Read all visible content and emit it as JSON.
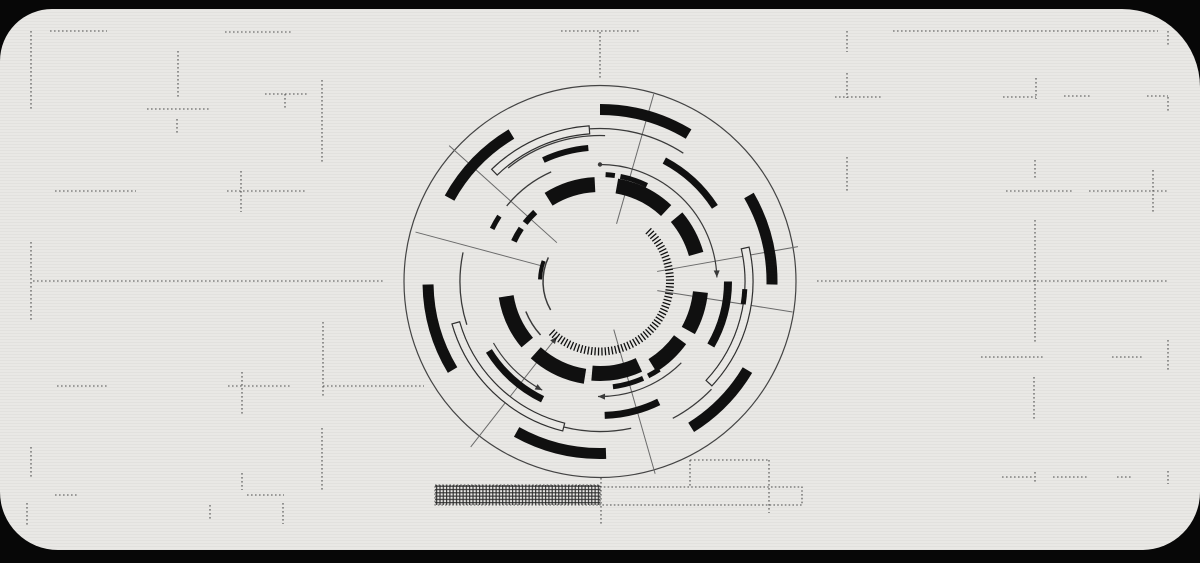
{
  "canvas": {
    "w": 1200,
    "h": 563,
    "bg": "#070707"
  },
  "panel": {
    "fill": "#e9e8e5"
  },
  "colors": {
    "solid_arc": "#101010",
    "thin_arc": "#3a3a3a",
    "outer_circle": "#444444",
    "spoke": "#6b6b6b",
    "dash_line": "#4f4f4f",
    "band_stroke": "#2f2f2f",
    "band_fill": "#e9e8e5",
    "hatch": "#2a2a2a"
  },
  "background_lines": [
    {
      "dir": "h",
      "x": 50,
      "y": 31,
      "len": 57
    },
    {
      "dir": "h",
      "x": 225,
      "y": 32,
      "len": 66
    },
    {
      "dir": "h",
      "x": 147,
      "y": 109,
      "len": 62
    },
    {
      "dir": "h",
      "x": 265,
      "y": 94,
      "len": 43
    },
    {
      "dir": "h",
      "x": 227,
      "y": 191,
      "len": 79
    },
    {
      "dir": "h",
      "x": 55,
      "y": 191,
      "len": 81
    },
    {
      "dir": "h",
      "x": 33,
      "y": 281,
      "len": 352
    },
    {
      "dir": "h",
      "x": 323,
      "y": 386,
      "len": 101
    },
    {
      "dir": "h",
      "x": 228,
      "y": 386,
      "len": 63
    },
    {
      "dir": "h",
      "x": 57,
      "y": 386,
      "len": 50
    },
    {
      "dir": "h",
      "x": 55,
      "y": 495,
      "len": 22
    },
    {
      "dir": "h",
      "x": 247,
      "y": 495,
      "len": 37
    },
    {
      "dir": "h",
      "x": 561,
      "y": 31,
      "len": 80
    },
    {
      "dir": "h",
      "x": 893,
      "y": 31,
      "len": 265
    },
    {
      "dir": "h",
      "x": 835,
      "y": 97,
      "len": 46
    },
    {
      "dir": "h",
      "x": 1003,
      "y": 97,
      "len": 33
    },
    {
      "dir": "h",
      "x": 1064,
      "y": 96,
      "len": 26
    },
    {
      "dir": "h",
      "x": 1147,
      "y": 96,
      "len": 21
    },
    {
      "dir": "h",
      "x": 1006,
      "y": 191,
      "len": 68
    },
    {
      "dir": "h",
      "x": 1089,
      "y": 191,
      "len": 80
    },
    {
      "dir": "h",
      "x": 817,
      "y": 281,
      "len": 351
    },
    {
      "dir": "h",
      "x": 981,
      "y": 357,
      "len": 62
    },
    {
      "dir": "h",
      "x": 1112,
      "y": 357,
      "len": 31
    },
    {
      "dir": "h",
      "x": 1002,
      "y": 477,
      "len": 31
    },
    {
      "dir": "h",
      "x": 1053,
      "y": 477,
      "len": 34
    },
    {
      "dir": "h",
      "x": 1117,
      "y": 477,
      "len": 16
    },
    {
      "dir": "h",
      "x": 690,
      "y": 460,
      "len": 79
    },
    {
      "dir": "v",
      "x": 31,
      "y": 31,
      "len": 79
    },
    {
      "dir": "v",
      "x": 178,
      "y": 51,
      "len": 46
    },
    {
      "dir": "v",
      "x": 177,
      "y": 119,
      "len": 15
    },
    {
      "dir": "v",
      "x": 285,
      "y": 94,
      "len": 16
    },
    {
      "dir": "v",
      "x": 322,
      "y": 80,
      "len": 83
    },
    {
      "dir": "v",
      "x": 241,
      "y": 171,
      "len": 41
    },
    {
      "dir": "v",
      "x": 31,
      "y": 242,
      "len": 80
    },
    {
      "dir": "v",
      "x": 323,
      "y": 322,
      "len": 76
    },
    {
      "dir": "v",
      "x": 242,
      "y": 372,
      "len": 43
    },
    {
      "dir": "v",
      "x": 31,
      "y": 447,
      "len": 31
    },
    {
      "dir": "v",
      "x": 242,
      "y": 473,
      "len": 17
    },
    {
      "dir": "v",
      "x": 322,
      "y": 428,
      "len": 62
    },
    {
      "dir": "v",
      "x": 27,
      "y": 503,
      "len": 22
    },
    {
      "dir": "v",
      "x": 210,
      "y": 505,
      "len": 15
    },
    {
      "dir": "v",
      "x": 283,
      "y": 503,
      "len": 21
    },
    {
      "dir": "v",
      "x": 600,
      "y": 32,
      "len": 48
    },
    {
      "dir": "v",
      "x": 847,
      "y": 31,
      "len": 21
    },
    {
      "dir": "v",
      "x": 847,
      "y": 73,
      "len": 25
    },
    {
      "dir": "v",
      "x": 1036,
      "y": 78,
      "len": 21
    },
    {
      "dir": "v",
      "x": 1168,
      "y": 31,
      "len": 14
    },
    {
      "dir": "v",
      "x": 1168,
      "y": 97,
      "len": 14
    },
    {
      "dir": "v",
      "x": 847,
      "y": 157,
      "len": 35
    },
    {
      "dir": "v",
      "x": 1035,
      "y": 160,
      "len": 18
    },
    {
      "dir": "v",
      "x": 1153,
      "y": 170,
      "len": 42
    },
    {
      "dir": "v",
      "x": 1035,
      "y": 220,
      "len": 122
    },
    {
      "dir": "v",
      "x": 1168,
      "y": 340,
      "len": 30
    },
    {
      "dir": "v",
      "x": 1034,
      "y": 377,
      "len": 43
    },
    {
      "dir": "v",
      "x": 1035,
      "y": 472,
      "len": 11
    },
    {
      "dir": "v",
      "x": 1168,
      "y": 471,
      "len": 13
    },
    {
      "dir": "v",
      "x": 601,
      "y": 478,
      "len": 48
    },
    {
      "dir": "v",
      "x": 690,
      "y": 460,
      "len": 27
    },
    {
      "dir": "v",
      "x": 769,
      "y": 460,
      "len": 53
    }
  ],
  "progress": {
    "hatch_rect": {
      "x": 435,
      "y": 485,
      "w": 165,
      "h": 20
    },
    "outline_rect": {
      "x": 600,
      "y": 487,
      "w": 202,
      "h": 18
    }
  },
  "circle": {
    "cx": 600,
    "cy": 281.5,
    "outer_circle": {
      "r": 196,
      "w": 1.2
    },
    "solid_arcs": [
      {
        "r": 172,
        "a0": -151,
        "a1": -121,
        "w": 11
      },
      {
        "r": 172,
        "a0": -90,
        "a1": -59,
        "w": 11
      },
      {
        "r": 172,
        "a0": -30,
        "a1": 1,
        "w": 11
      },
      {
        "r": 172,
        "a0": 31,
        "a1": 58,
        "w": 11
      },
      {
        "r": 172,
        "a0": 88,
        "a1": 119,
        "w": 11
      },
      {
        "r": 172,
        "a0": 149,
        "a1": 179,
        "w": 11
      },
      {
        "r": 97,
        "a0": -122,
        "a1": -93,
        "w": 15
      },
      {
        "r": 97,
        "a0": -80,
        "a1": -47,
        "w": 15
      },
      {
        "r": 100,
        "a0": -40,
        "a1": -16,
        "w": 15
      },
      {
        "r": 101,
        "a0": 6,
        "a1": 29,
        "w": 15
      },
      {
        "r": 99,
        "a0": 36,
        "a1": 58,
        "w": 15
      },
      {
        "r": 92,
        "a0": 65,
        "a1": 95,
        "w": 15
      },
      {
        "r": 96,
        "a0": 99,
        "a1": 132,
        "w": 15
      },
      {
        "r": 95,
        "a0": 140,
        "a1": 171,
        "w": 15
      },
      {
        "r": 134,
        "a0": -115,
        "a1": -95,
        "w": 6
      },
      {
        "r": 137,
        "a0": -62,
        "a1": -33,
        "w": 7
      },
      {
        "r": 128,
        "a0": 0,
        "a1": 30,
        "w": 8
      },
      {
        "r": 134,
        "a0": 64,
        "a1": 88,
        "w": 7
      },
      {
        "r": 131,
        "a0": 116,
        "a1": 148,
        "w": 7
      },
      {
        "r": 107,
        "a0": -87,
        "a1": -82,
        "w": 5
      },
      {
        "r": 107,
        "a0": -79,
        "a1": -64,
        "w": 5
      },
      {
        "r": 106,
        "a0": 66,
        "a1": 83,
        "w": 5
      },
      {
        "r": 106,
        "a0": 56,
        "a1": 63,
        "w": 5
      },
      {
        "r": 95,
        "a0": -155,
        "a1": -146,
        "w": 6
      },
      {
        "r": 95,
        "a0": -142,
        "a1": -133,
        "w": 6
      },
      {
        "r": 120,
        "a0": -154,
        "a1": -147,
        "w": 5
      },
      {
        "r": 60,
        "a0": -178,
        "a1": -160,
        "w": 4
      },
      {
        "r": 145,
        "a0": 3,
        "a1": 9,
        "w": 5
      }
    ],
    "thin_arcs": [
      {
        "r": 153,
        "a0": -94,
        "a1": -57,
        "w": 1.3
      },
      {
        "r": 146,
        "a0": -129,
        "a1": -88,
        "w": 1.3
      },
      {
        "r": 150,
        "a0": 78,
        "a1": 104,
        "w": 1.3
      },
      {
        "r": 155,
        "a0": 44,
        "a1": 62,
        "w": 1.3
      },
      {
        "r": 120,
        "a0": -141,
        "a1": -114,
        "w": 1.3
      },
      {
        "r": 140,
        "a0": 162,
        "a1": 192,
        "w": 1.3
      },
      {
        "r": 57,
        "a0": 150,
        "a1": 205,
        "w": 1.5
      },
      {
        "r": 80,
        "a0": 138,
        "a1": 158,
        "w": 1.5
      }
    ],
    "bands": [
      {
        "r0": 148,
        "r1": 156,
        "a0": -134,
        "a1": -94
      },
      {
        "r0": 146,
        "r1": 154,
        "a0": 104,
        "a1": 164
      },
      {
        "r0": 145,
        "r1": 153,
        "a0": -13,
        "a1": 43
      }
    ],
    "arrow_arcs": [
      {
        "r": 117,
        "a0": -90,
        "a1": -2,
        "arrow": "end",
        "dot": true
      },
      {
        "r": 115,
        "a0": 45,
        "a1": 91,
        "arrow": "end",
        "dot": false
      },
      {
        "r": 123,
        "a0": 118,
        "a1": 150,
        "arrow": "start",
        "dot": false
      }
    ],
    "tick_ring": {
      "r0": 66,
      "r1": 74,
      "a0": -46,
      "a1": 134,
      "step": 2.8,
      "w": 1.3
    },
    "spokes": [
      {
        "angle": -74,
        "r0": 60,
        "r1": 195
      },
      {
        "angle": -138,
        "r0": 58,
        "r1": 203
      },
      {
        "angle": -165,
        "r0": 62,
        "r1": 191
      },
      {
        "angle": 128,
        "r0": 70,
        "r1": 210,
        "arrow": "inner"
      },
      {
        "angle": 74,
        "r0": 50,
        "r1": 200
      },
      {
        "angle": -10,
        "r0": 58,
        "r1": 201
      },
      {
        "angle": 9,
        "r0": 58,
        "r1": 195
      }
    ]
  }
}
